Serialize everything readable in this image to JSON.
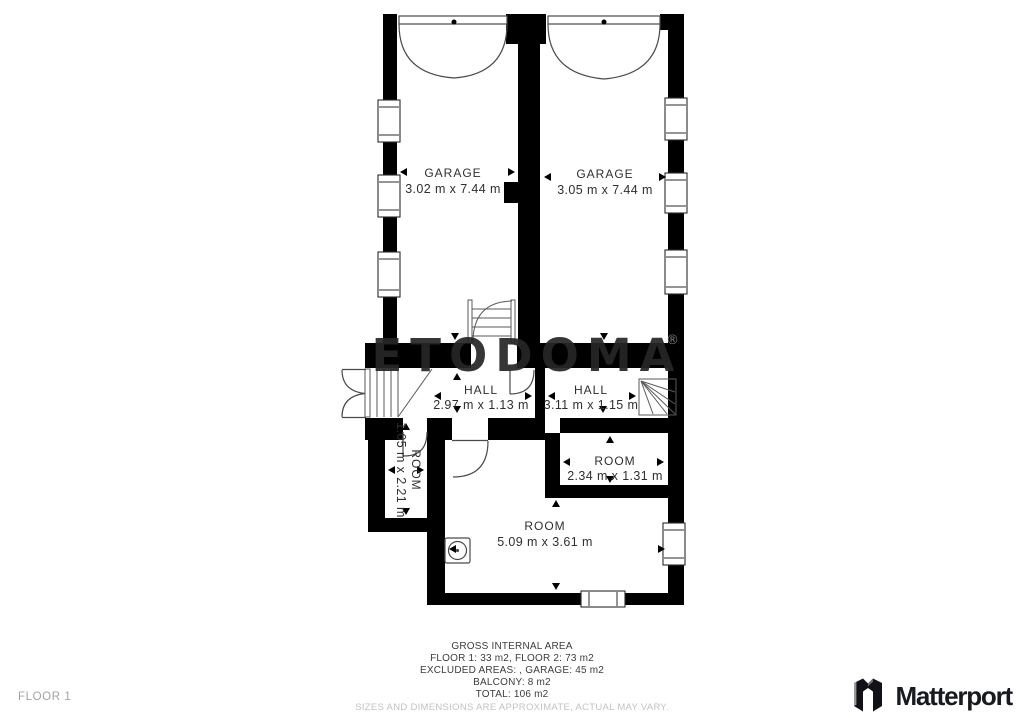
{
  "plan": {
    "watermark": {
      "text": "ETODOMA",
      "registered": "®"
    },
    "rooms": {
      "garage_left": {
        "name": "GARAGE",
        "dims": "3.02 m x 7.44 m"
      },
      "garage_right": {
        "name": "GARAGE",
        "dims": "3.05 m x 7.44 m"
      },
      "hall_left": {
        "name": "HALL",
        "dims": "2.97 m x 1.13 m"
      },
      "hall_right": {
        "name": "HALL",
        "dims": "3.11 m x 1.15 m"
      },
      "room_small": {
        "name": "ROOM",
        "dims": "1.05 m x 2.21 m"
      },
      "room_mid": {
        "name": "ROOM",
        "dims": "2.34 m x 1.31 m"
      },
      "room_large": {
        "name": "ROOM",
        "dims": "5.09 m x 3.61 m"
      }
    }
  },
  "footer": {
    "area_summary": {
      "title": "GROSS INTERNAL AREA",
      "floors": "FLOOR 1: 33 m2, FLOOR 2: 73 m2",
      "excluded": "EXCLUDED AREAS: , GARAGE: 45 m2",
      "balcony": "BALCONY: 8 m2",
      "total": "TOTAL: 106 m2",
      "disclaimer": "SIZES AND DIMENSIONS ARE APPROXIMATE, ACTUAL MAY VARY."
    },
    "floor_label": "FLOOR 1",
    "brand": "Matterport"
  },
  "colors": {
    "wall": "#000000",
    "symbol_line": "#4a4a4a",
    "watermark": "#262626",
    "label_text": "#2f2f2f",
    "muted_text": "#a3a3a3",
    "disclaimer_text": "#c2c2c2",
    "brand_text": "#181a20"
  }
}
